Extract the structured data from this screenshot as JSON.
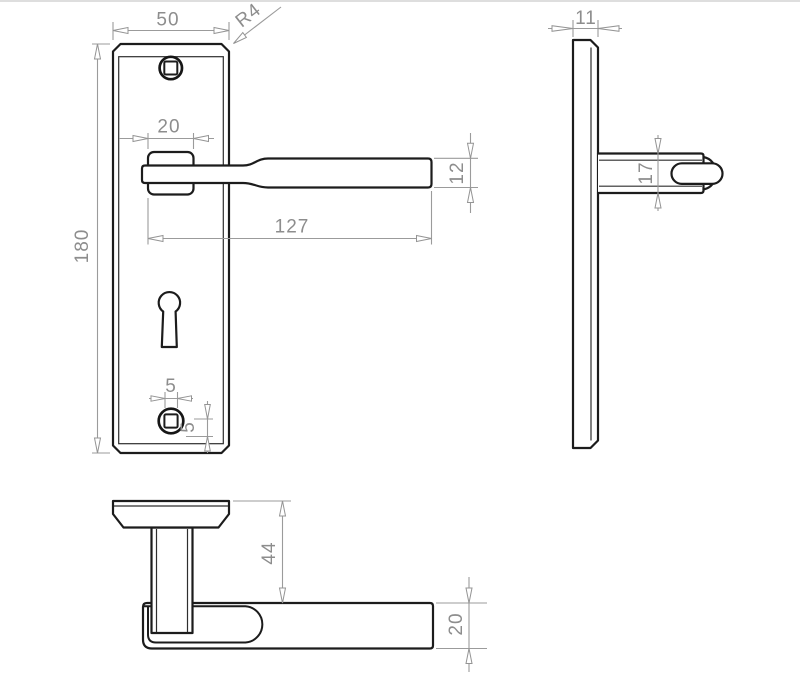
{
  "drawing": {
    "kind": "technical-drawing",
    "subject": "Lever door handle on backplate - dimensioned orthographic views (front, side, bottom)",
    "units": "mm",
    "colors": {
      "geometry_line": "#1c1c1c",
      "dimension_line": "#9b9b9b",
      "dimension_text": "#8d8d8d",
      "background": "#ffffff"
    },
    "views": {
      "front": "front view of backplate with lever, keyhole and screw holes",
      "side": "side profile of plate and lever",
      "bottom": "bottom view showing handle projection"
    },
    "dims": {
      "plate_width": "50",
      "corner_radius": "R4",
      "plate_height": "180",
      "boss_width": "20",
      "lever_length": "127",
      "lever_height": "12",
      "hole_width": "5",
      "hole_offset": "5",
      "plate_thickness": "11",
      "lever_thickness": "17",
      "handle_projection": "44",
      "grip_depth": "20"
    }
  }
}
